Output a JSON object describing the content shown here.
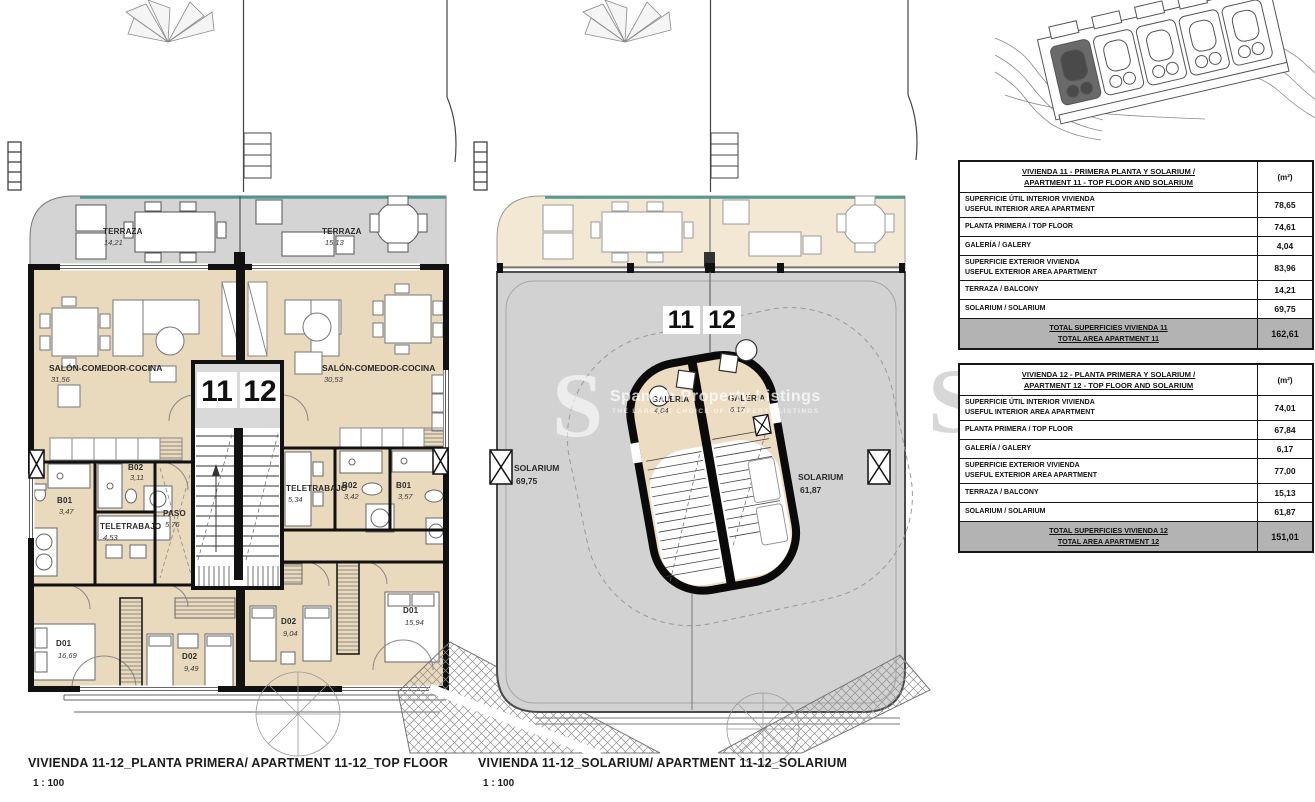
{
  "colors": {
    "room_beige": "#e9d9bd",
    "terrace_gray": "#d4d4d4",
    "terrace_beige": "#f2e8d4",
    "solarium_gray": "#d2d2d2",
    "wall_black": "#111111",
    "balustrade_teal": "#4d9a92",
    "table_total_gray": "#b3b3b3"
  },
  "watermark": {
    "letter": "S",
    "brand": "Spanish Property Listings",
    "tagline": "THE LARGEST CHOICE OF PROPERTY LISTINGS"
  },
  "plans": {
    "top_floor": {
      "caption": "VIVIENDA 11-12_PLANTA PRIMERA/ APARTMENT 11-12_TOP FLOOR",
      "scale": "1 : 100",
      "unit1": "11",
      "unit2": "12",
      "rooms": {
        "terraza11": {
          "name": "TERRAZA",
          "area": "14,21"
        },
        "terraza12": {
          "name": "TERRAZA",
          "area": "15,13"
        },
        "salon11": {
          "name": "SALÓN-COMEDOR-COCINA",
          "area": "31,56"
        },
        "salon12": {
          "name": "SALÓN-COMEDOR-COCINA",
          "area": "30,53"
        },
        "b02_11": {
          "name": "B02",
          "area": "3,11"
        },
        "b01_11": {
          "name": "B01",
          "area": "3,47"
        },
        "tele11": {
          "name": "TELETRABAJO",
          "area": "4,53"
        },
        "paso11": {
          "name": "PASO",
          "area": "5,76"
        },
        "d01_11": {
          "name": "D01",
          "area": "16,69"
        },
        "d02_11": {
          "name": "D02",
          "area": "9,49"
        },
        "tele12": {
          "name": "TELETRABAJO",
          "area": "5,34"
        },
        "b02_12": {
          "name": "B02",
          "area": "3,42"
        },
        "b01_12": {
          "name": "B01",
          "area": "3,57"
        },
        "d02_12": {
          "name": "D02",
          "area": "9,04"
        },
        "d01_12": {
          "name": "D01",
          "area": "15,94"
        }
      }
    },
    "solarium": {
      "caption": "VIVIENDA 11-12_SOLARIUM/ APARTMENT 11-12_SOLARIUM",
      "scale": "1 : 100",
      "unit1": "11",
      "unit2": "12",
      "rooms": {
        "galeria11": {
          "name": "GALERIA",
          "area": "4,04"
        },
        "galeria12": {
          "name": "GALERIA",
          "area": "6,17"
        },
        "solarium11": {
          "name": "SOLARIUM",
          "area": "69,75"
        },
        "solarium12": {
          "name": "SOLARIUM",
          "area": "61,87"
        }
      }
    }
  },
  "table11": {
    "title1": "VIVIENDA 11 - PRIMERA PLANTA Y SOLARIUM /",
    "title2": "APARTMENT 11 - TOP FLOOR AND SOLARIUM",
    "unit": "(m²)",
    "rows": [
      {
        "l1": "SUPERFICIE ÚTIL INTERIOR VIVIENDA",
        "l2": "USEFUL INTERIOR AREA APARTMENT",
        "v": "78,65"
      },
      {
        "l1": "PLANTA PRIMERA / TOP FLOOR",
        "l2": "",
        "v": "74,61"
      },
      {
        "l1": "GALERÍA / GALERY",
        "l2": "",
        "v": "4,04"
      },
      {
        "l1": "SUPERFICIE EXTERIOR VIVIENDA",
        "l2": "USEFUL EXTERIOR AREA APARTMENT",
        "v": "83,96"
      },
      {
        "l1": "TERRAZA / BALCONY",
        "l2": "",
        "v": "14,21"
      },
      {
        "l1": "SOLARIUM / SOLARIUM",
        "l2": "",
        "v": "69,75"
      }
    ],
    "total1": "TOTAL SUPERFICIES VIVIENDA 11",
    "total2": "TOTAL AREA APARTMENT 11",
    "totalValue": "162,61"
  },
  "table12": {
    "title1": "VIVIENDA 12 - PLANTA PRIMERA Y SOLARIUM /",
    "title2": "APARTMENT 12 - TOP FLOOR AND SOLARIUM",
    "unit": "(m²)",
    "rows": [
      {
        "l1": "SUPERFICIE ÚTIL INTERIOR VIVIENDA",
        "l2": "USEFUL INTERIOR AREA APARTMENT",
        "v": "74,01"
      },
      {
        "l1": "PLANTA PRIMERA / TOP FLOOR",
        "l2": "",
        "v": "67,84"
      },
      {
        "l1": "GALERÍA / GALERY",
        "l2": "",
        "v": "6,17"
      },
      {
        "l1": "SUPERFICIE EXTERIOR VIVIENDA",
        "l2": "USEFUL EXTERIOR AREA APARTMENT",
        "v": "77,00"
      },
      {
        "l1": "TERRAZA / BALCONY",
        "l2": "",
        "v": "15,13"
      },
      {
        "l1": "SOLARIUM / SOLARIUM",
        "l2": "",
        "v": "61,87"
      }
    ],
    "total1": "TOTAL SUPERFICIES VIVIENDA 12",
    "total2": "TOTAL AREA APARTMENT 12",
    "totalValue": "151,01"
  }
}
